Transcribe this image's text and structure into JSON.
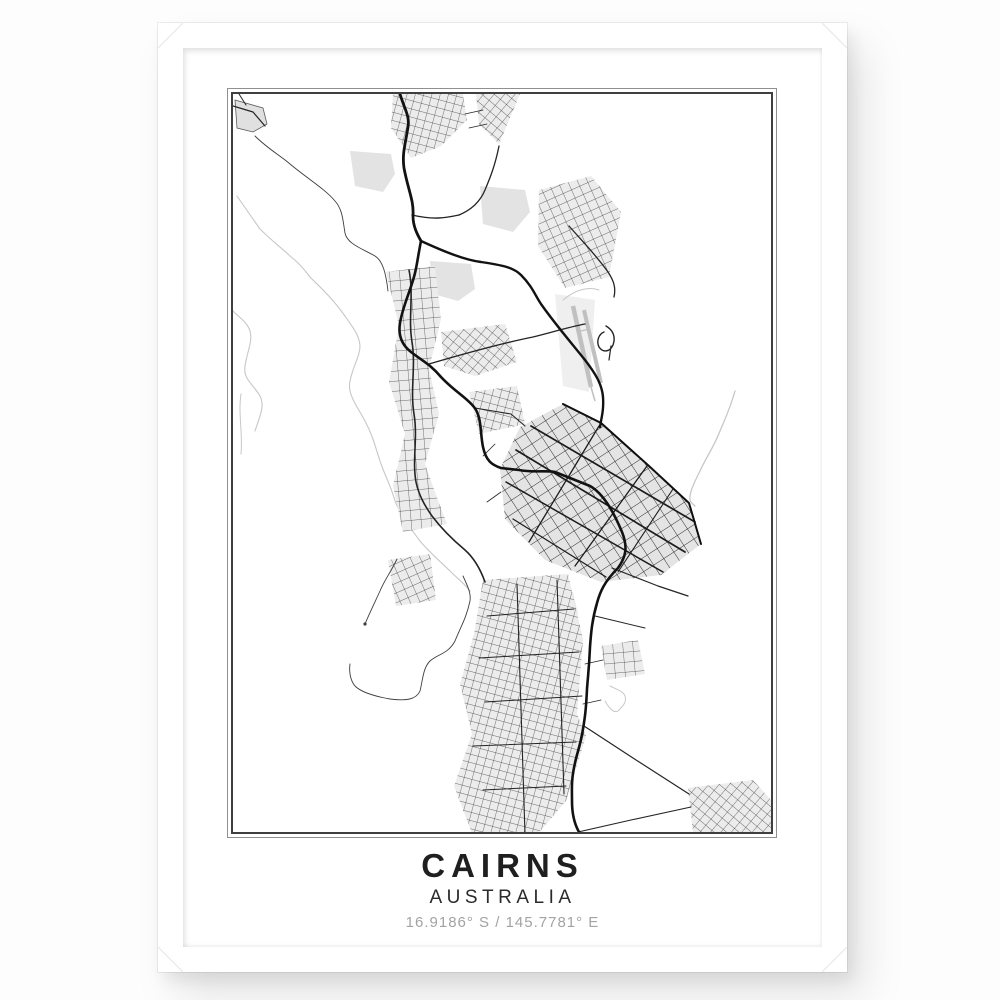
{
  "poster": {
    "title": "CAIRNS",
    "subtitle": "AUSTRALIA",
    "coordinates": "16.9186° S / 145.7781° E"
  },
  "colors": {
    "page_background": "#fdfdfd",
    "frame": "#ffffff",
    "mat": "#ffffff",
    "plate_border_outer": "#909090",
    "plate_border_inner": "#3f3f3f",
    "road_black": "#121212",
    "creek_dark": "#3e3e3e",
    "river_gray": "#c7c7c7",
    "urban_gray": "#ececec",
    "runway_gray": "#c0c0c0",
    "title_text": "#1f1f1f",
    "subtitle_text": "#2b2b2b",
    "coordinates_text": "#a3a3a3"
  }
}
